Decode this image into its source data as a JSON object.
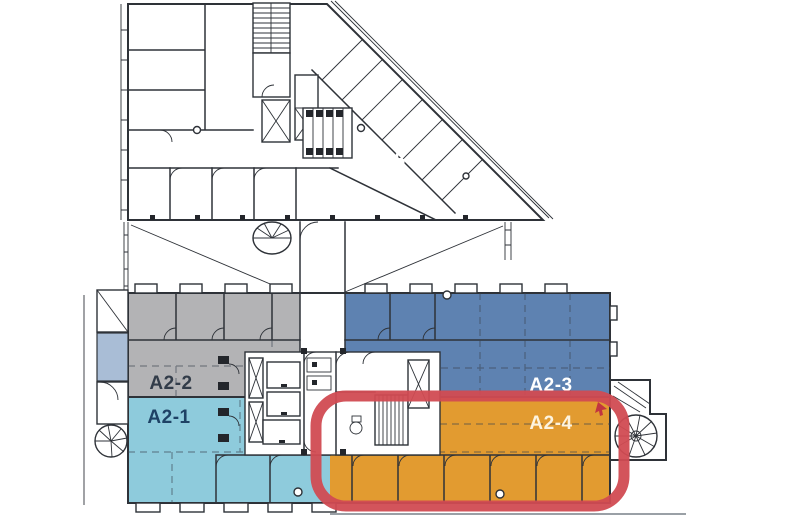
{
  "page": {
    "background": "#ffffff"
  },
  "plan": {
    "title": "building-floor-plan",
    "zones": {
      "a2_1": {
        "label": "A2-1",
        "color": "#8ecbdc",
        "label_color": "#1e4265"
      },
      "a2_2": {
        "label": "A2-2",
        "color": "#b3b3b5",
        "label_color": "#323c49"
      },
      "a2_3": {
        "label": "A2-3",
        "color": "#5e82b1",
        "label_color": "#ffffff"
      },
      "a2_4": {
        "label": "A2-4",
        "color": "#e29b30",
        "label_color": "#fdf4df"
      },
      "a2_5": {
        "label": "A2-5",
        "color": "#8bc53f",
        "label_color": "#ffffff"
      }
    },
    "highlight": {
      "color": "#d14b52",
      "highlighted_zone": "A2-4"
    },
    "line_color": "#2e3238"
  }
}
